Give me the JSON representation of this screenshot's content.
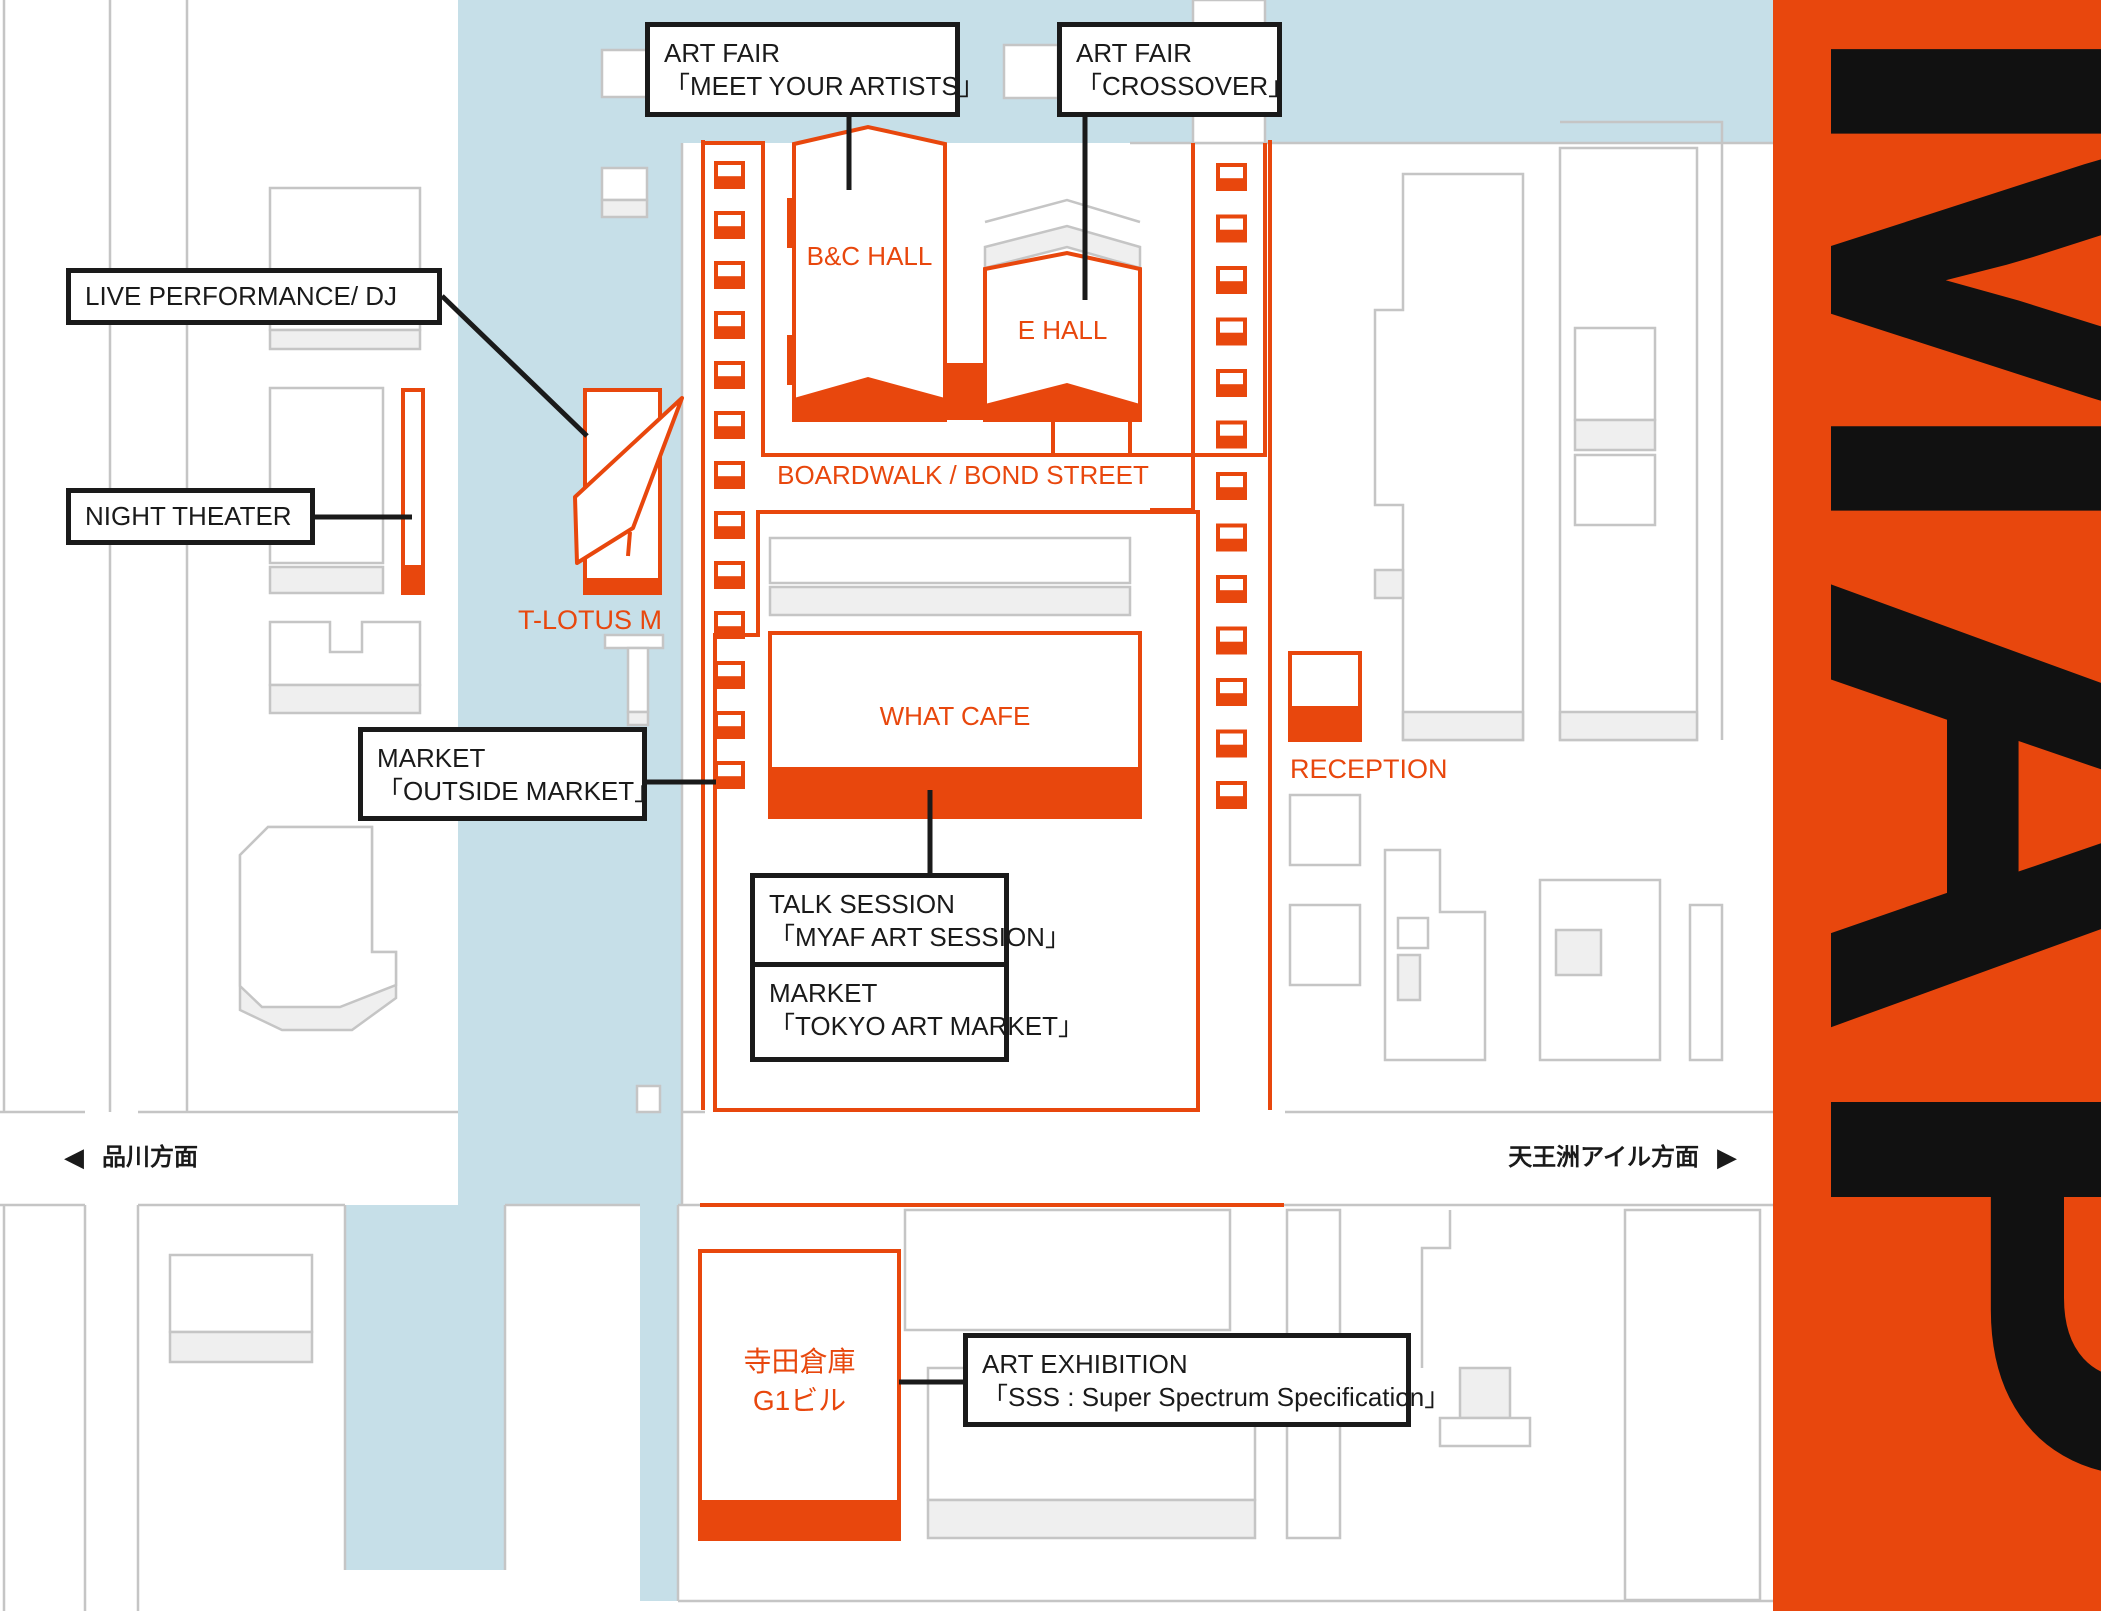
{
  "callouts": {
    "myaf": {
      "line1": "ART FAIR",
      "line2": "「MEET YOUR ARTISTS」"
    },
    "crossover": {
      "line1": "ART FAIR",
      "line2": "「CROSSOVER」"
    },
    "live_dj": {
      "line1": "LIVE PERFORMANCE/ DJ"
    },
    "night_theater": {
      "line1": "NIGHT THEATER"
    },
    "market_outside": {
      "line1": "MARKET",
      "line2": "「OUTSIDE MARKET」"
    },
    "talk_session": {
      "line1": "TALK SESSION",
      "line2": "「MYAF ART SESSION」"
    },
    "market_tokyo": {
      "line1": "MARKET",
      "line2": "「TOKYO ART MARKET」"
    },
    "art_exhibition": {
      "line1": "ART EXHIBITION",
      "line2": "「SSS : Super Spectrum Specification」"
    }
  },
  "venues": {
    "bc_hall": "B&C HALL",
    "e_hall": "E HALL",
    "boardwalk": "BOARDWALK / BOND STREET",
    "what_cafe": "WHAT CAFE",
    "t_lotus_m": "T-LOTUS M",
    "reception": "RECEPTION",
    "terrada_line1": "寺田倉庫",
    "terrada_line2": "G1ビル"
  },
  "directions": {
    "west": "品川方面",
    "east": "天王洲アイル方面",
    "west_arrow": "◀",
    "east_arrow": "▶"
  },
  "sidebar": {
    "title": "MAP"
  },
  "colors": {
    "accent": "#E8470D",
    "water": "#C6DFE8",
    "gray_line": "#C5C5C5",
    "gray_fill": "#EFEFEF",
    "ink": "#1A1A1A"
  }
}
